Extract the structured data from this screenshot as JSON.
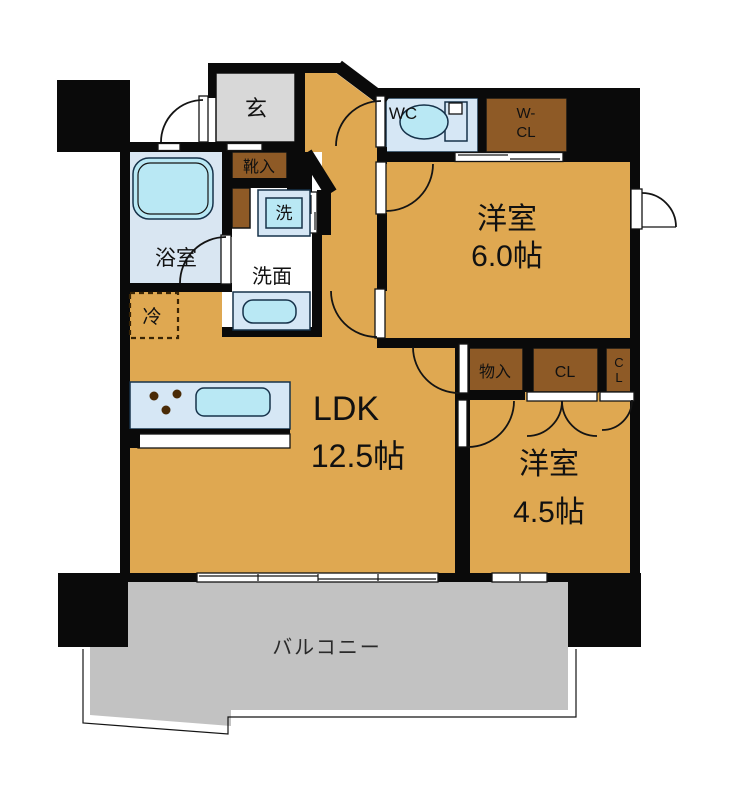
{
  "palette": {
    "wall": "#0a0a0a",
    "room_tan": "#dfa851",
    "closet_brown": "#8e5a26",
    "entrance_gray": "#d8d8d8",
    "balcony_gray": "#c2c2c2",
    "bath_floor": "#d9e6f2",
    "fixture_pale_blue": "#d6e7f5",
    "fixture_cyan": "#b9e8f4",
    "burner_brown": "#4a2b07",
    "dash_brown": "#3a2505",
    "text_black": "#111111"
  },
  "labels": {
    "entrance": "玄",
    "shoe_cabinet": "靴入",
    "bathroom": "浴室",
    "washer": "洗",
    "washroom": "洗面",
    "refrigerator": "冷",
    "toilet": "WC",
    "walkin_closet_line1": "W-",
    "walkin_closet_line2": "CL",
    "bedroom1_name": "洋室",
    "bedroom1_size": "6.0帖",
    "storage": "物入",
    "closet": "CL",
    "closet2_line1": "C",
    "closet2_line2": "L",
    "ldk_name": "LDK",
    "ldk_size": "12.5帖",
    "bedroom2_name": "洋室",
    "bedroom2_size": "4.5帖",
    "balcony": "バルコニー"
  }
}
